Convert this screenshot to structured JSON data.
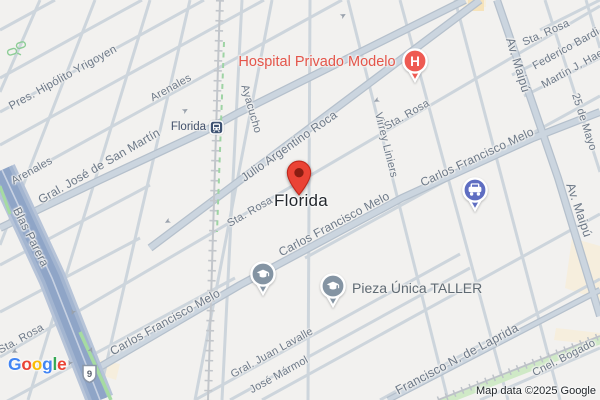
{
  "place": {
    "name": "Florida",
    "pin_color": "#ea4335",
    "pin_edge_color": "#c0271c",
    "pin_inner_color": "#8a1d12",
    "x": 301,
    "y": 201
  },
  "transit_station": {
    "name": "Florida",
    "color": "#3f5373",
    "x": 216,
    "y": 127
  },
  "route_shield": {
    "number": "9",
    "x": 89,
    "y": 374
  },
  "attribution": {
    "text": "Map data ©2025 Google"
  },
  "logo": {
    "text": "Google",
    "letters": [
      {
        "ch": "G",
        "color": "#4285F4"
      },
      {
        "ch": "o",
        "color": "#EA4335"
      },
      {
        "ch": "o",
        "color": "#FBBC05"
      },
      {
        "ch": "g",
        "color": "#4285F4"
      },
      {
        "ch": "l",
        "color": "#34A853"
      },
      {
        "ch": "e",
        "color": "#EA4335"
      }
    ]
  },
  "street_labels": [
    {
      "text": "Pres. Hipólito Yrigoyen",
      "x": 63,
      "y": 78,
      "rot": -29,
      "size": 11.5
    },
    {
      "text": "Arenales",
      "x": 171,
      "y": 88,
      "rot": -29,
      "size": 11
    },
    {
      "text": "Arenales",
      "x": 32,
      "y": 171,
      "rot": -29,
      "size": 11
    },
    {
      "text": "Gral. José de San Martín",
      "x": 99,
      "y": 166,
      "rot": -30,
      "size": 12
    },
    {
      "text": "Julio Argentino Roca",
      "x": 289,
      "y": 146,
      "rot": -35,
      "size": 12
    },
    {
      "text": "Ayacucho",
      "x": 251,
      "y": 109,
      "rot": 74,
      "size": 11
    },
    {
      "text": "Virrey Liniers",
      "x": 386,
      "y": 145,
      "rot": 76,
      "size": 11
    },
    {
      "text": "Sta. Rosa",
      "x": 250,
      "y": 212,
      "rot": -30,
      "size": 11
    },
    {
      "text": "Sta. Rosa",
      "x": 407,
      "y": 115,
      "rot": -30,
      "size": 11
    },
    {
      "text": "Sta. Rosa",
      "x": 546,
      "y": 33,
      "rot": -24,
      "size": 11
    },
    {
      "text": "Sta. Rosa",
      "x": 21,
      "y": 339,
      "rot": -29,
      "size": 11
    },
    {
      "text": "Av. Maipú",
      "x": 518,
      "y": 65,
      "rot": 73,
      "size": 12.5
    },
    {
      "text": "Av. Maipú",
      "x": 579,
      "y": 210,
      "rot": 71,
      "size": 12.5
    },
    {
      "text": "25 de Mayo",
      "x": 584,
      "y": 122,
      "rot": 72,
      "size": 11
    },
    {
      "text": "Federico Bardi",
      "x": 566,
      "y": 49,
      "rot": -29,
      "size": 11
    },
    {
      "text": "Martín J. Haedo",
      "x": 578,
      "y": 66,
      "rot": -29,
      "size": 11
    },
    {
      "text": "Blas Parera",
      "x": 31,
      "y": 237,
      "rot": 63,
      "size": 12
    },
    {
      "text": "Carlos Francisco Melo",
      "x": 165,
      "y": 322,
      "rot": -29,
      "size": 12
    },
    {
      "text": "Carlos Francisco Melo",
      "x": 334,
      "y": 224,
      "rot": -28,
      "size": 12
    },
    {
      "text": "Carlos Francisco Melo",
      "x": 477,
      "y": 157,
      "rot": -25,
      "size": 12
    },
    {
      "text": "Gral. Juan Lavalle",
      "x": 272,
      "y": 353,
      "rot": -29,
      "size": 11
    },
    {
      "text": "José Mármol",
      "x": 279,
      "y": 375,
      "rot": -29,
      "size": 11
    },
    {
      "text": "Francisco N. de Laprida",
      "x": 457,
      "y": 359,
      "rot": -28,
      "size": 12.5
    },
    {
      "text": "Cnel. Bogado",
      "x": 564,
      "y": 358,
      "rot": -27,
      "size": 11
    }
  ],
  "pois": [
    {
      "type": "hospital-pin",
      "x": 415,
      "y": 61,
      "color": "#ee5a52",
      "label": "Hospital Privado Modelo",
      "label_x": 317,
      "label_y": 62,
      "label_color": "#e4554a",
      "label_size": 14.5,
      "label_anchor": "center"
    },
    {
      "type": "education-pin",
      "x": 263,
      "y": 274,
      "color": "#8494a3"
    },
    {
      "type": "education-pin",
      "x": 333,
      "y": 286,
      "color": "#8494a3",
      "label": "Pieza Única TALLER",
      "label_x": 352,
      "label_y": 288,
      "label_color": "#5f6a73",
      "label_size": 14,
      "label_anchor": "left"
    },
    {
      "type": "car-pin",
      "x": 475,
      "y": 190,
      "color": "#5f6ec2"
    }
  ],
  "one_way_arrows": [
    {
      "x": 186,
      "y": 111,
      "rot": -30
    },
    {
      "x": 344,
      "y": 16,
      "rot": -30
    },
    {
      "x": 377,
      "y": 100,
      "rot": 152
    },
    {
      "x": 168,
      "y": 221,
      "rot": 152
    },
    {
      "x": 73,
      "y": 312,
      "rot": 113
    },
    {
      "x": 92,
      "y": 350,
      "rot": -67
    },
    {
      "x": 70,
      "y": 363,
      "rot": 113
    },
    {
      "x": 15,
      "y": 351,
      "rot": 152
    }
  ]
}
